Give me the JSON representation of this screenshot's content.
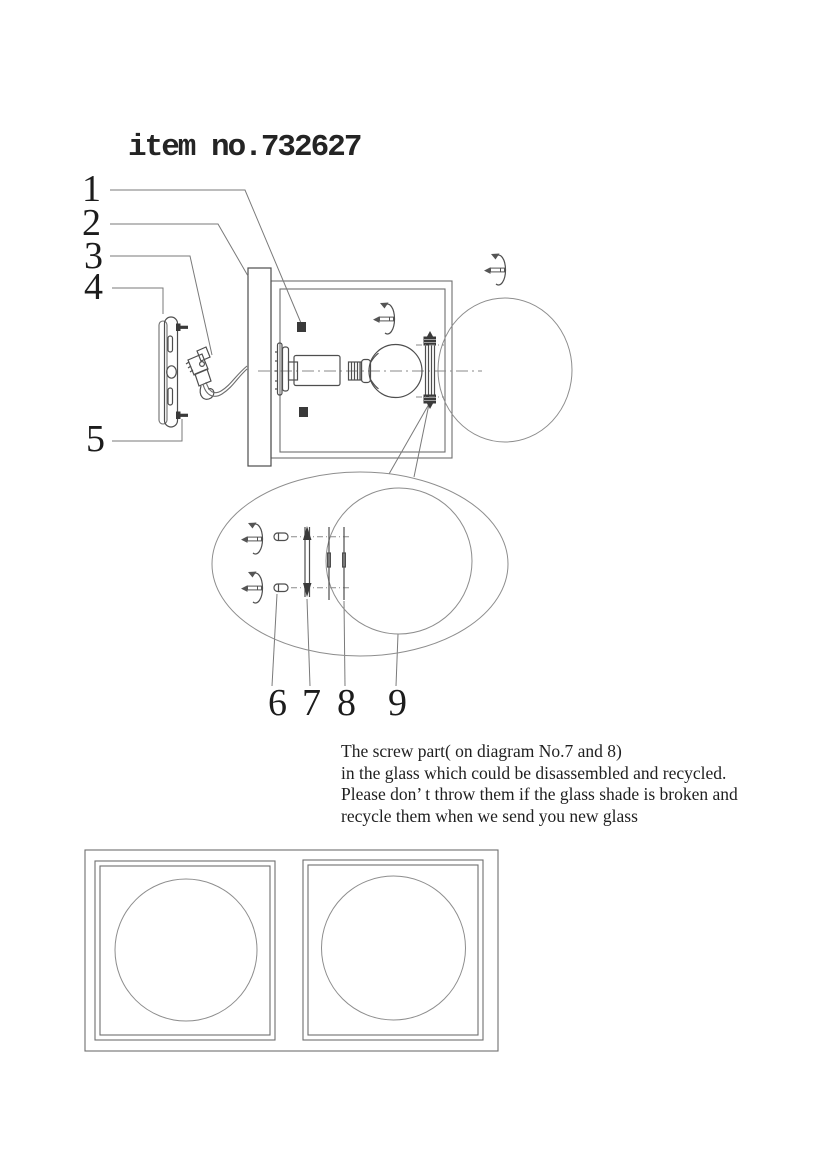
{
  "title": "item no.732627",
  "part_labels": {
    "l1": "1",
    "l2": "2",
    "l3": "3",
    "l4": "4",
    "l5": "5",
    "l6": "6",
    "l7": "7",
    "l8": "8",
    "l9": "9"
  },
  "recycle_note": {
    "line1": "The screw part( on diagram No.7 and 8)",
    "line2": "in the glass which could be disassembled and recycled.",
    "line3": "Please don’ t throw them if the glass shade is broken and",
    "line4": "recycle them when we send you new glass"
  },
  "icons": {
    "turn_screw_icon": "curved-rotation-arrow-around-screw"
  },
  "colors": {
    "paper": "#ffffff",
    "ink": "#2a2a2a",
    "line": "#6e6e6e"
  }
}
